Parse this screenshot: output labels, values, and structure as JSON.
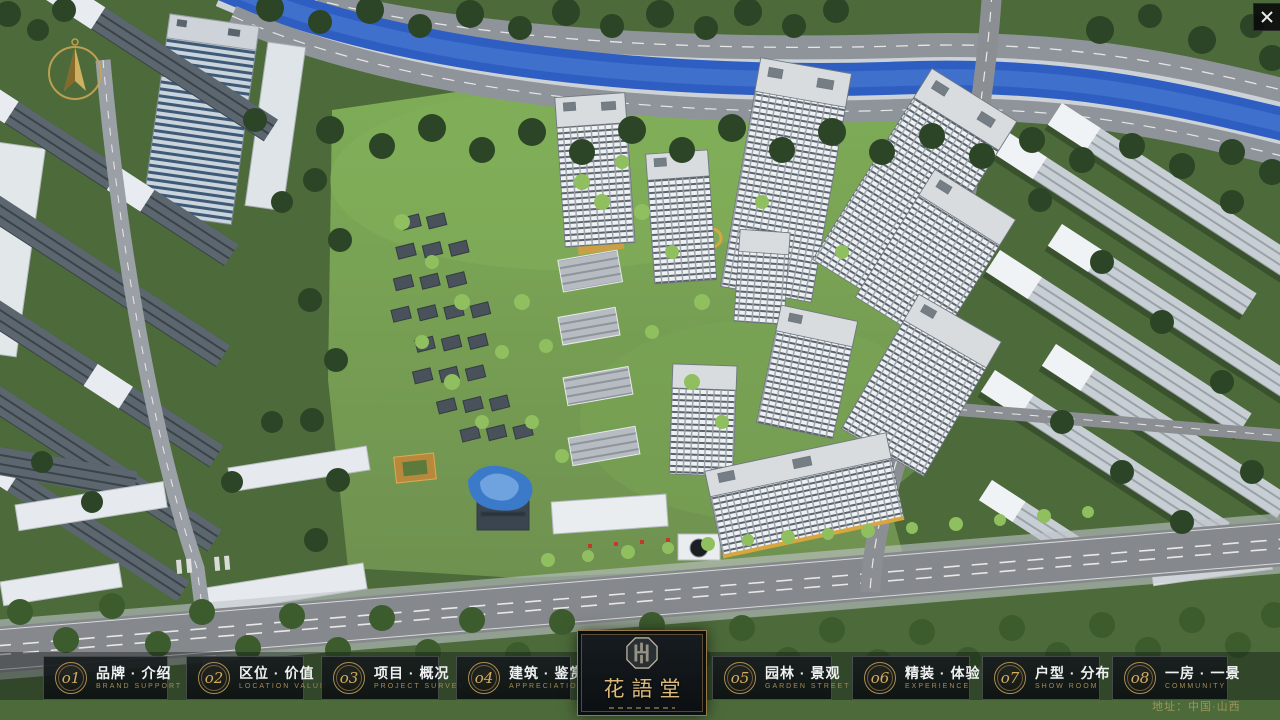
{
  "window": {
    "close_glyph": "✕"
  },
  "compass": {
    "meaning": "north-indicator"
  },
  "logo": {
    "title": "花語堂",
    "seal": "octagon-seal-emblem"
  },
  "navbar": {
    "items": [
      {
        "num": "o1",
        "label": "品牌 · 介绍",
        "sub": "BRAND SUPPORT"
      },
      {
        "num": "o2",
        "label": "区位 · 价值",
        "sub": "LOCATION VALUE"
      },
      {
        "num": "o3",
        "label": "项目 · 概况",
        "sub": "PROJECT SURVEY"
      },
      {
        "num": "o4",
        "label": "建筑 · 鉴赏",
        "sub": "APPRECIATION"
      },
      {
        "num": "o5",
        "label": "园林 · 景观",
        "sub": "GARDEN STREET"
      },
      {
        "num": "o6",
        "label": "精装 · 体验",
        "sub": "EXPERIENCE"
      },
      {
        "num": "o7",
        "label": "户型 · 分布",
        "sub": "SHOW ROOM"
      },
      {
        "num": "o8",
        "label": "一房 · 一景",
        "sub": "COMMUNITY"
      }
    ]
  },
  "footer": {
    "address": "地址：中国·山西"
  },
  "colors": {
    "gold": "#c9a55f",
    "panel": "rgba(13,17,20,0.78)",
    "river": "#2e5ec2",
    "grass": "#6f9150",
    "roof_white": "#e8ecf0",
    "road": "#85888c"
  }
}
